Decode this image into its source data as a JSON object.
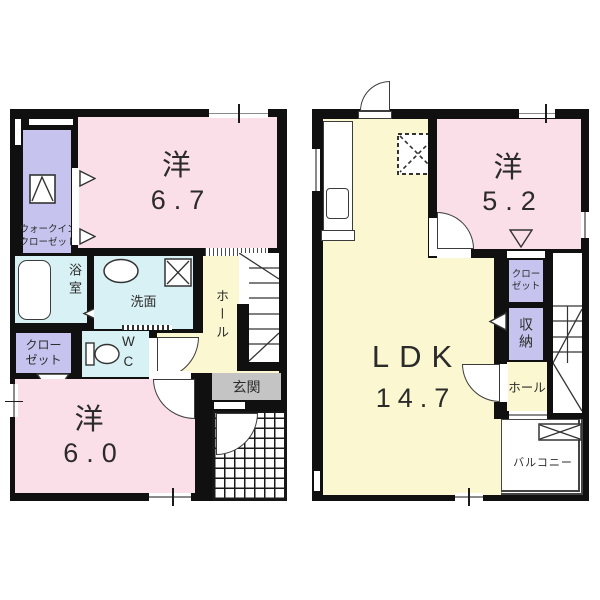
{
  "floor1": {
    "wic": {
      "line1": "ウォークイン",
      "line2": "クローゼット"
    },
    "bedroom1": {
      "kind": "洋",
      "size": "6.7"
    },
    "bath": "浴室",
    "washroom": "洗面",
    "hall": "ホール",
    "closet": {
      "line1": "クロー",
      "line2": "ゼット"
    },
    "wc": {
      "line1": "W",
      "line2": "C"
    },
    "entrance": "玄関",
    "bedroom2": {
      "kind": "洋",
      "size": "6.0"
    }
  },
  "floor2": {
    "ldk": {
      "kind": "LDK",
      "size": "14.7"
    },
    "bedroom3": {
      "kind": "洋",
      "size": "5.2"
    },
    "closet": {
      "line1": "クロー",
      "line2": "ゼット"
    },
    "storage": "収納",
    "hall": "ホール",
    "balcony": "バルコニー"
  },
  "colors": {
    "wall": "#101010",
    "room_pink": "#fadee8",
    "room_purple": "#c6c4ee",
    "room_cyan": "#d8f1f4",
    "room_yellow": "#fbf7d0",
    "entrance_gray": "#c4c4c4",
    "text": "#2b2b2b"
  }
}
